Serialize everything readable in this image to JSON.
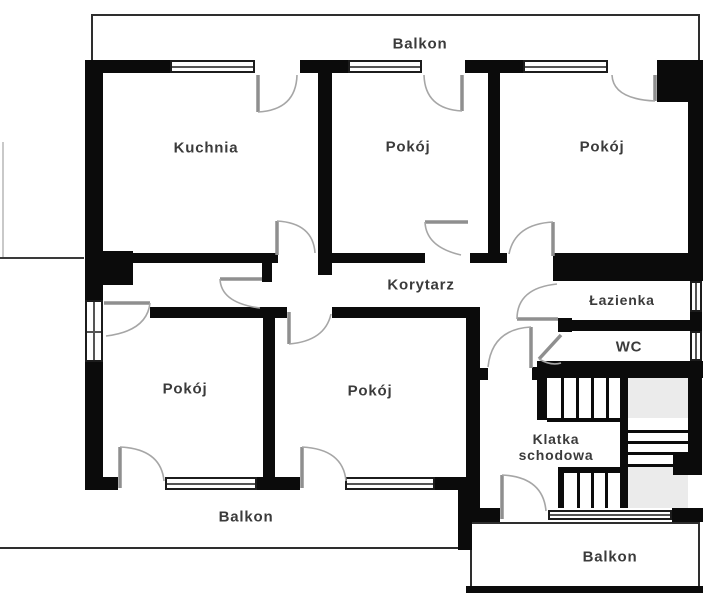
{
  "plan": {
    "labels": {
      "balcony_top": "Balkon",
      "kitchen": "Kuchnia",
      "room_top_middle": "Pokój",
      "room_top_right": "Pokój",
      "corridor": "Korytarz",
      "bathroom": "Łazienka",
      "wc": "WC",
      "room_bottom_left": "Pokój",
      "room_bottom_middle": "Pokój",
      "staircase": "Klatka schodowa",
      "balcony_bottom_left": "Balkon",
      "balcony_bottom_right": "Balkon"
    },
    "colors": {
      "wall": "#0b0b0b",
      "background": "#ffffff",
      "stair_landing": "#ebebeb",
      "door_arc": "#9a9a9a",
      "text": "#3b3b3b"
    }
  }
}
